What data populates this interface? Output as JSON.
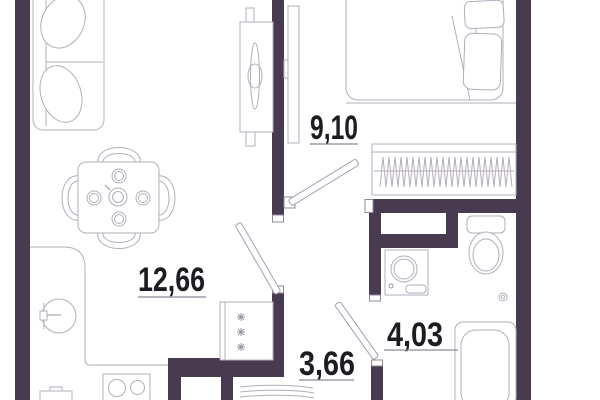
{
  "plan": {
    "type": "apartment-floor-plan",
    "rooms": [
      {
        "name": "living-room-kitchen",
        "area_label": "12,66"
      },
      {
        "name": "bedroom",
        "area_label": "9,10"
      },
      {
        "name": "hallway",
        "area_label": "3,66"
      },
      {
        "name": "bathroom",
        "area_label": "4,03"
      }
    ],
    "colors": {
      "wall": "#483a4f",
      "furniture_outline": "#b3acbb",
      "label_text": "#1e1b22",
      "label_underline": "#8f8898",
      "background": "#ffffff"
    },
    "furniture_icons": [
      "sofa-icon",
      "cushion-icon",
      "dining-table-icon",
      "chair-icon",
      "plate-icon",
      "teapot-icon",
      "tv-stand-icon",
      "tv-icon",
      "bed-icon",
      "pillow-icon",
      "wardrobe-icon",
      "hangers-icon",
      "kitchen-counter-icon",
      "sink-icon",
      "tap-icon",
      "stove-icon",
      "kitchen-cabinet-icon",
      "fridge-icon",
      "snowflake-icon",
      "toilet-icon",
      "washing-machine-icon",
      "bathtub-icon",
      "duct-shaft-icon",
      "door-swing-icon",
      "shoe-rack-icon",
      "holder-icon"
    ]
  }
}
